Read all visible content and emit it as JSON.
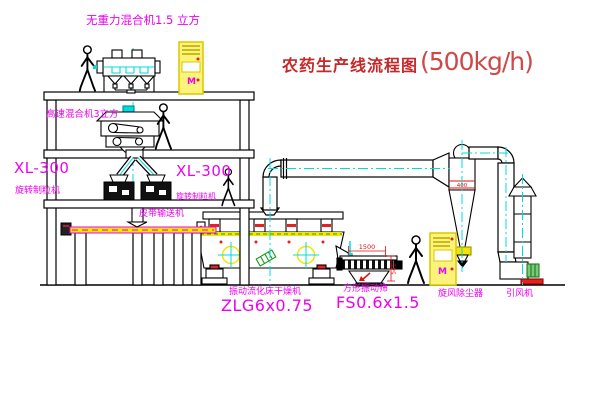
{
  "title": {
    "main": "农药生产线流程图",
    "capacity": "(500kg/h)"
  },
  "labels": {
    "top_mixer": "无重力混合机1.5 立方",
    "floor2_mixer": "高速混合机3立方",
    "granulator_model_left": "XL-300",
    "granulator_name_left": "旋转制粒机",
    "granulator_model_right": "XL-300",
    "granulator_name_right": "旋转制粒机",
    "belt_conveyor": "皮带输送机",
    "dryer_name": "振动流化床干燥机",
    "dryer_model": "ZLG6x0.75",
    "screen_name": "方形振动筛",
    "screen_model": "FS0.6x1.5",
    "cyclone_name": "旋风除尘器",
    "fan_name": "引风机"
  },
  "dims": {
    "screen_width": "1500",
    "screen_height": "541",
    "cyclone_band": "400"
  },
  "symbols": {
    "cabinet_motor": "M"
  },
  "colors": {
    "label_magenta": "#ee00ee",
    "title_red": "#c62828",
    "centerline_cyan": "#00dcdc",
    "cabinet_yellow": "#f5e400",
    "machine_green": "#1a9c1a",
    "dim_red": "#e01010"
  }
}
